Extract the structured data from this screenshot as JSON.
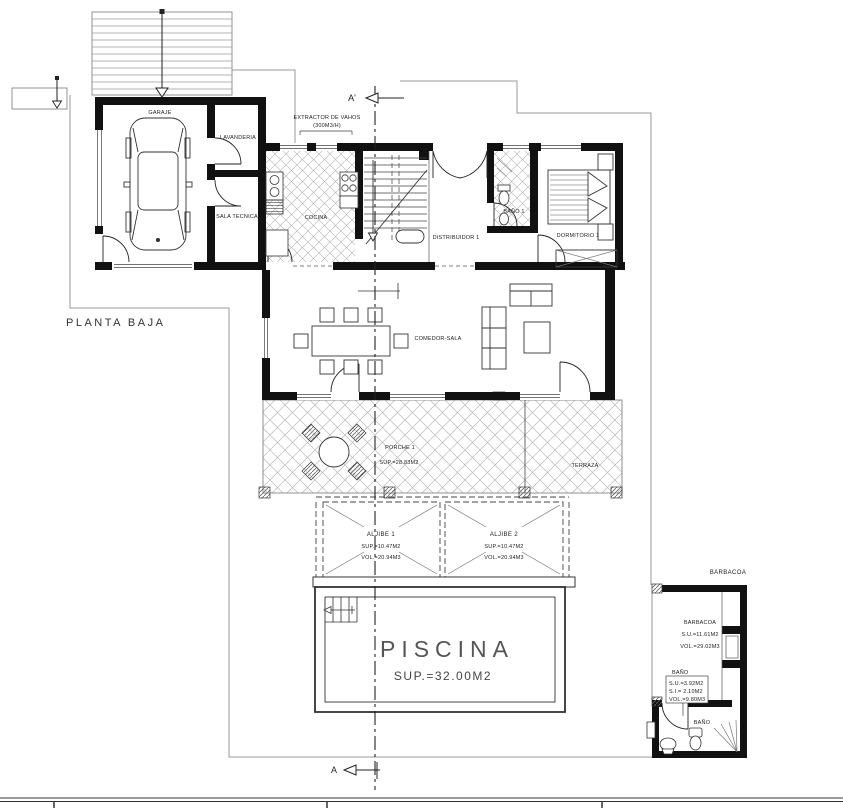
{
  "plan": {
    "title": "PLANTA BAJA",
    "section": {
      "top": "A'",
      "bottom": "A"
    },
    "annotations": {
      "extractor_line1": "EXTRACTOR DE VAHOS",
      "extractor_line2": "(300M3/H)"
    },
    "rooms": {
      "garaje": "GARAJE",
      "lavanderia": "LAVANDERIA",
      "sala_tecnica": "SALA TECNICA",
      "cocina": "COCINA",
      "distribuidor": "DISTRIBUIDOR 1",
      "bano1": "BAÑO 1",
      "dormitorio1": "DORMITORIO 1",
      "comedor": "COMEDOR-SALA",
      "porche": {
        "name": "PORCHE 1",
        "sup": "SUP.=28.83M2"
      },
      "terraza": "TERRAZA"
    },
    "aljibe1": {
      "name": "ALJIBE 1",
      "sup": "SUP.=10.47M2",
      "vol": "VOL.=20.94M3"
    },
    "aljibe2": {
      "name": "ALJIBE 2",
      "sup": "SUP.=10.47M2",
      "vol": "VOL.=20.94M3"
    },
    "piscina": {
      "name": "PISCINA",
      "sup": "SUP.=32.00M2"
    },
    "barbacoa": {
      "title": "BARBACOA",
      "room": {
        "name": "BARBACOA",
        "su": "S.U.=11.61M2",
        "vol": "VOL.=29.02M3"
      },
      "bano": {
        "name": "BAÑO",
        "su": "S.U.=3.92M2",
        "si": "S.I.= 2.10M2",
        "vol": "VOL.=9.80M3",
        "room_label": "BAÑO"
      }
    }
  }
}
